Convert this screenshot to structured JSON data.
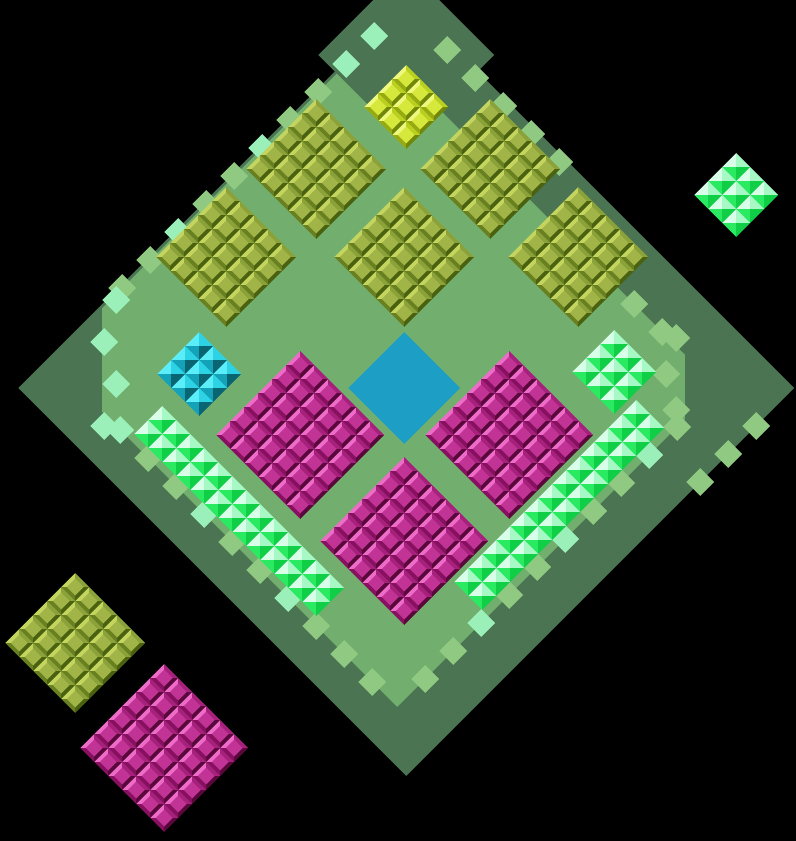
{
  "board": {
    "width": 796,
    "height": 841,
    "background_color": "#000000",
    "tile_size": 28,
    "colors": {
      "dark_green": "#4a7452",
      "light_green": "#72ae6e",
      "step_light": "#90c981",
      "step_mint": "#9af0b8",
      "center_blue": "#1d9ec4"
    },
    "base_shapes": {
      "outer_dark_diamond": {
        "points": [
          [
            406,
            0
          ],
          [
            794,
            388
          ],
          [
            406,
            776
          ],
          [
            18,
            388
          ]
        ]
      },
      "inner_light_field": {
        "points": [
          [
            370,
            40
          ],
          [
            685,
            355
          ],
          [
            685,
            419
          ],
          [
            397,
            707
          ],
          [
            102,
            412
          ],
          [
            102,
            308
          ]
        ]
      },
      "apex_dark_diamond": {
        "cx": 406,
        "cy": 55,
        "r": 88
      },
      "center_blue_diamond": {
        "cx": 404,
        "cy": 388,
        "r": 56
      }
    },
    "palettes": {
      "olive": {
        "style": "gem",
        "face": "#a0b447",
        "tl": "#c3d55f",
        "tr": "#8ba139",
        "bl": "#68801f",
        "br": "#4a610f"
      },
      "yellow": {
        "style": "gem",
        "face": "#d6e83b",
        "tl": "#eef87f",
        "tr": "#bad020",
        "bl": "#95ab11",
        "br": "#70870a"
      },
      "magenta": {
        "style": "gem",
        "face": "#c13394",
        "tl": "#ec6cc7",
        "tr": "#a5217c",
        "bl": "#871060",
        "br": "#5a083c"
      },
      "cyan": {
        "style": "pyramid",
        "tl": "#5beef8",
        "tr": "#2dd3e4",
        "bl": "#14a2b8",
        "br": "#0a6573"
      },
      "mint": {
        "style": "pyramid",
        "tl": "#d8ffe7",
        "tr": "#a6f9c5",
        "bl": "#2aea61",
        "br": "#10cf47"
      }
    },
    "blocks": [
      {
        "id": "yellow-top",
        "palette": "yellow",
        "n": 3,
        "cx": 406,
        "cy": 107
      },
      {
        "id": "olive-upper-left",
        "palette": "olive",
        "n": 5,
        "cx": 316,
        "cy": 169
      },
      {
        "id": "olive-upper-right",
        "palette": "olive",
        "n": 5,
        "cx": 490,
        "cy": 169
      },
      {
        "id": "olive-left",
        "palette": "olive",
        "n": 5,
        "cx": 226,
        "cy": 257
      },
      {
        "id": "olive-center",
        "palette": "olive",
        "n": 5,
        "cx": 404,
        "cy": 257
      },
      {
        "id": "olive-right",
        "palette": "olive",
        "n": 5,
        "cx": 578,
        "cy": 257
      },
      {
        "id": "cyan-left",
        "palette": "cyan",
        "n": 3,
        "cx": 199,
        "cy": 374
      },
      {
        "id": "mint-right",
        "palette": "mint",
        "n": 3,
        "cx": 614,
        "cy": 372
      },
      {
        "id": "magenta-left",
        "palette": "magenta",
        "n": 6,
        "cx": 300,
        "cy": 435
      },
      {
        "id": "magenta-right",
        "palette": "magenta",
        "n": 6,
        "cx": 509,
        "cy": 435
      },
      {
        "id": "magenta-bottom",
        "palette": "magenta",
        "n": 6,
        "cx": 404,
        "cy": 541
      },
      {
        "id": "olive-outside-sw",
        "palette": "olive",
        "n": 5,
        "cx": 75,
        "cy": 643
      },
      {
        "id": "magenta-outside-sw",
        "palette": "magenta",
        "n": 6,
        "cx": 164,
        "cy": 748
      },
      {
        "id": "mint-outside-ne",
        "palette": "mint",
        "n": 3,
        "cx": 736,
        "cy": 195
      }
    ],
    "strips": [
      {
        "id": "mint-strip-sw",
        "palette": "mint",
        "count": 13,
        "start": [
          148,
          434
        ],
        "step": [
          14,
          14
        ],
        "across": [
          14,
          -14
        ]
      },
      {
        "id": "mint-strip-se",
        "palette": "mint",
        "count": 13,
        "start": [
          650,
          428
        ],
        "step": [
          -14,
          14
        ],
        "across": [
          -14,
          -14
        ]
      }
    ],
    "edge_steps": [
      [
        122,
        288,
        "light"
      ],
      [
        150,
        260,
        "light"
      ],
      [
        178,
        232,
        "mint"
      ],
      [
        206,
        204,
        "light"
      ],
      [
        234,
        176,
        "light"
      ],
      [
        262,
        148,
        "mint"
      ],
      [
        290,
        120,
        "light"
      ],
      [
        318,
        92,
        "light"
      ],
      [
        346,
        64,
        "mint"
      ],
      [
        374,
        36,
        "mint"
      ],
      [
        116,
        300,
        "mint"
      ],
      [
        104,
        342,
        "mint"
      ],
      [
        116,
        384,
        "mint"
      ],
      [
        104,
        426,
        "mint"
      ],
      [
        120,
        430,
        "mint"
      ],
      [
        148,
        458,
        "light"
      ],
      [
        176,
        486,
        "light"
      ],
      [
        204,
        514,
        "mint"
      ],
      [
        232,
        542,
        "light"
      ],
      [
        260,
        570,
        "light"
      ],
      [
        288,
        598,
        "mint"
      ],
      [
        316,
        626,
        "light"
      ],
      [
        344,
        654,
        "light"
      ],
      [
        372,
        682,
        "light"
      ],
      [
        425,
        679,
        "light"
      ],
      [
        453,
        651,
        "light"
      ],
      [
        481,
        623,
        "mint"
      ],
      [
        509,
        595,
        "light"
      ],
      [
        537,
        567,
        "light"
      ],
      [
        565,
        539,
        "mint"
      ],
      [
        593,
        511,
        "light"
      ],
      [
        621,
        483,
        "light"
      ],
      [
        649,
        455,
        "mint"
      ],
      [
        677,
        427,
        "light"
      ],
      [
        676,
        338,
        "light"
      ],
      [
        666,
        374,
        "light"
      ],
      [
        676,
        410,
        "light"
      ],
      [
        447,
        50,
        "light"
      ],
      [
        475,
        78,
        "light"
      ],
      [
        503,
        106,
        "light"
      ],
      [
        531,
        134,
        "light"
      ],
      [
        559,
        162,
        "light"
      ],
      [
        634,
        304,
        "light"
      ],
      [
        662,
        332,
        "light"
      ],
      [
        756,
        426,
        "light"
      ],
      [
        728,
        454,
        "light"
      ],
      [
        700,
        482,
        "light"
      ]
    ]
  }
}
